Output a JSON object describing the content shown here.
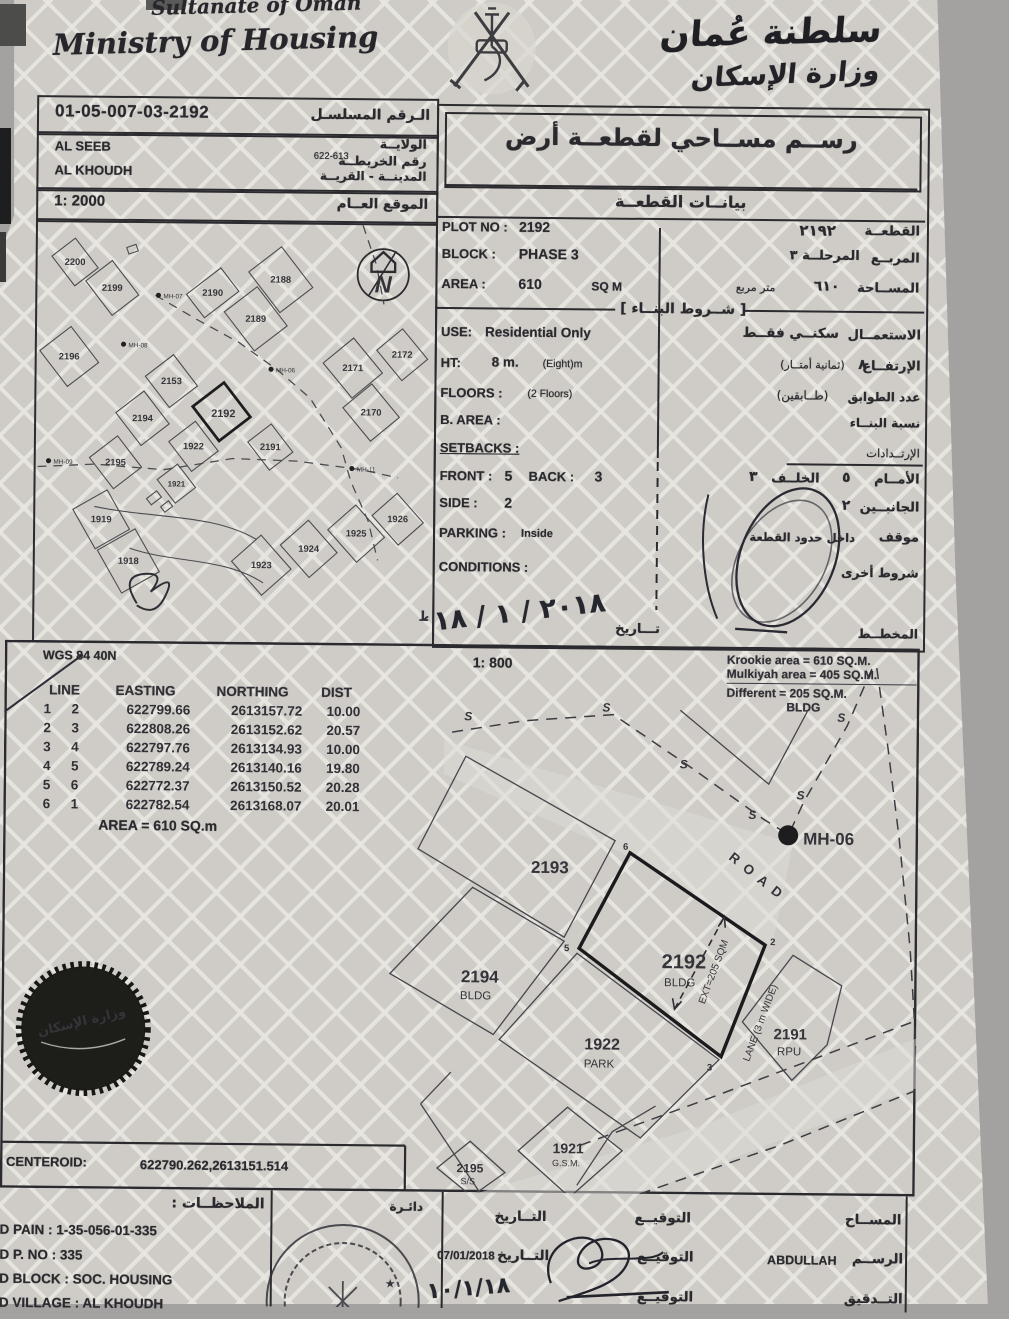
{
  "header": {
    "country": "Sultanate of Oman",
    "ministry": "Ministry of Housing",
    "country_ar": "سلطنة عُمان",
    "ministry_ar": "وزارة الإسكان"
  },
  "serial": {
    "value": "01-05-007-03-2192",
    "label_ar": "الـرقم المسلسـل"
  },
  "location_box": {
    "wilayat": "AL SEEB",
    "village": "AL KHOUDH",
    "wilayat_label_ar": "الولايــة",
    "map_label_ar": "رقم الخريطــة",
    "map_no": "622-613",
    "city_label_ar": "المدينــة - القريــة"
  },
  "scale_box": {
    "scale": "1: 2000",
    "label_ar": "الموقع العــام"
  },
  "location_map": {
    "plots": [
      "2200",
      "2199",
      "2190",
      "2188",
      "2189",
      "2196",
      "2153",
      "2192",
      "2194",
      "2171",
      "2172",
      "2170",
      "1922",
      "2191",
      "2195",
      "1921",
      "1919",
      "1918",
      "1923",
      "1924",
      "1925",
      "1926"
    ],
    "manholes": [
      "MH-07",
      "MH-08",
      "MH-06",
      "MH-09",
      "MH-11"
    ],
    "north": "N",
    "projection_ar": "الإســقاط"
  },
  "plot_panel": {
    "title_ar": "رســم مســاحي لقطعــة أرض",
    "subtitle_ar": "بيانــات القطعــة",
    "plot_no_label": "PLOT NO :",
    "plot_no": "2192",
    "plot_ar_val": "٢١٩٢",
    "plot_label_ar": "القطعــة",
    "block_label": "BLOCK :",
    "block": "PHASE 3",
    "block_ar_val": "المرحلــة ٣",
    "block_label_ar": "المربــع",
    "area_label": "AREA :",
    "area": "610",
    "area_unit": "SQ M",
    "area_ar_val": "٦١٠",
    "area_unit_ar": "متر مربع",
    "area_label_ar": "المســاحة",
    "conditions_header_ar": "[ شــروط البنــاء ]",
    "use_label": "USE:",
    "use": "Residential Only",
    "use_ar": "سكنــي فقــط",
    "use_label_ar": "الاستعمــال",
    "ht_label": "HT:",
    "ht": "8 m.",
    "ht_note": "(Eight)m",
    "ht_ar_val": "٨",
    "ht_ar_note": "(ثمانية أمتــار)",
    "ht_label_ar": "الإرتفــاع",
    "floors_label": "FLOORS :",
    "floors": "(2 Floors)",
    "floors_ar": "(طــابقين)",
    "floors_label_ar": "عدد الطوابق",
    "barea_label": "B. AREA :",
    "barea_label_ar": "نسبة البنــاء",
    "setbacks_label": "SETBACKS :",
    "setbacks_label_ar": "الإرتــدادات",
    "front_label": "FRONT :",
    "front": "5",
    "back_label": "BACK :",
    "back": "3",
    "front_label_ar": "الأمــام",
    "front_ar": "٥",
    "back_label_ar": "الخلــف",
    "back_ar": "٣",
    "side_label": "SIDE :",
    "side": "2",
    "side_label_ar": "الجانبــين",
    "side_ar": "٢",
    "parking_label": "PARKING :",
    "parking": "Inside",
    "parking_label_ar": "موقف",
    "parking_ar": "داخل حدود القطعة",
    "cond_label": "CONDITIONS :",
    "cond_label_ar": "شروط أخرى",
    "planner_label_ar": "المخطــط",
    "date_word_ar": "تـــاريخ",
    "plan_date_hand": "٢٠١٨ / ١ / ١٨"
  },
  "survey": {
    "datum": "WGS 84  40N",
    "scale": "1: 800",
    "area_line1": "Krookie  area = 610 SQ.M.",
    "area_line2": "Mulkiyah area = 405 SQ.M.",
    "area_line3": "Different        = 205 SQ.M.",
    "area_line4": "BLDG",
    "table": {
      "h_line": "LINE",
      "h_easting": "EASTING",
      "h_northing": "NORTHING",
      "h_dist": "DIST",
      "rows": [
        [
          "1",
          "2",
          "622799.66",
          "2613157.72",
          "10.00"
        ],
        [
          "2",
          "3",
          "622808.26",
          "2613152.62",
          "20.57"
        ],
        [
          "3",
          "4",
          "622797.76",
          "2613134.93",
          "10.00"
        ],
        [
          "4",
          "5",
          "622789.24",
          "2613140.16",
          "19.80"
        ],
        [
          "5",
          "6",
          "622772.37",
          "2613150.52",
          "20.28"
        ],
        [
          "6",
          "1",
          "622782.54",
          "2613168.07",
          "20.01"
        ]
      ],
      "area_note": "AREA = 610  SQ.m"
    },
    "road": "ROAD",
    "lane": "LANE (3 m WIDE)",
    "ext": "EXT=205 SQM",
    "manhole": "MH-06",
    "s1": "S",
    "s2": "S",
    "s3": "S",
    "s4": "S",
    "s5": "S",
    "s6": "S",
    "plots": {
      "p2193": "2193",
      "p2192": "2192",
      "p2192_use": "BLDG",
      "p2194": "2194",
      "p2194_use": "BLDG",
      "p1922": "1922",
      "p1922_use": "PARK",
      "p2191": "2191",
      "p2191_use": "RPU",
      "p1921": "1921",
      "p1921_use": "G.S.M.",
      "p2195": "2195",
      "p2195_use": "S/S"
    },
    "vertices": [
      "6",
      "5",
      "2",
      "3"
    ],
    "centeroid_label": "CENTEROID:",
    "centeroid": "622790.262,2613151.514",
    "seal_ar": "وزارة الإسكان"
  },
  "notes": {
    "header_ar": "الملاحظــات :",
    "line1": "LD PAIN : 1-35-056-01-335",
    "line2": "LD P. NO : 335",
    "line3": "LD BLOCK : SOC. HOUSING",
    "line4": "LD VILLAGE : AL KHOUDH"
  },
  "signatures": {
    "stamp_partial_ar": "دائـرة",
    "row1_role_ar": "المســاح",
    "row1_sig_ar": "التوقيــع",
    "row1_date_ar": "التــاريخ",
    "row2_role_ar": "الرســم",
    "row2_name": "ABDULLAH",
    "row2_sig_ar": "التوقيــع",
    "row2_date_ar": "التــاريخ",
    "row2_date": "07/01/2018",
    "row3_role_ar": "التــدقيق",
    "row3_sig_ar": "التوقيــع",
    "row3_date_hand": "١٠/١/١٨"
  }
}
